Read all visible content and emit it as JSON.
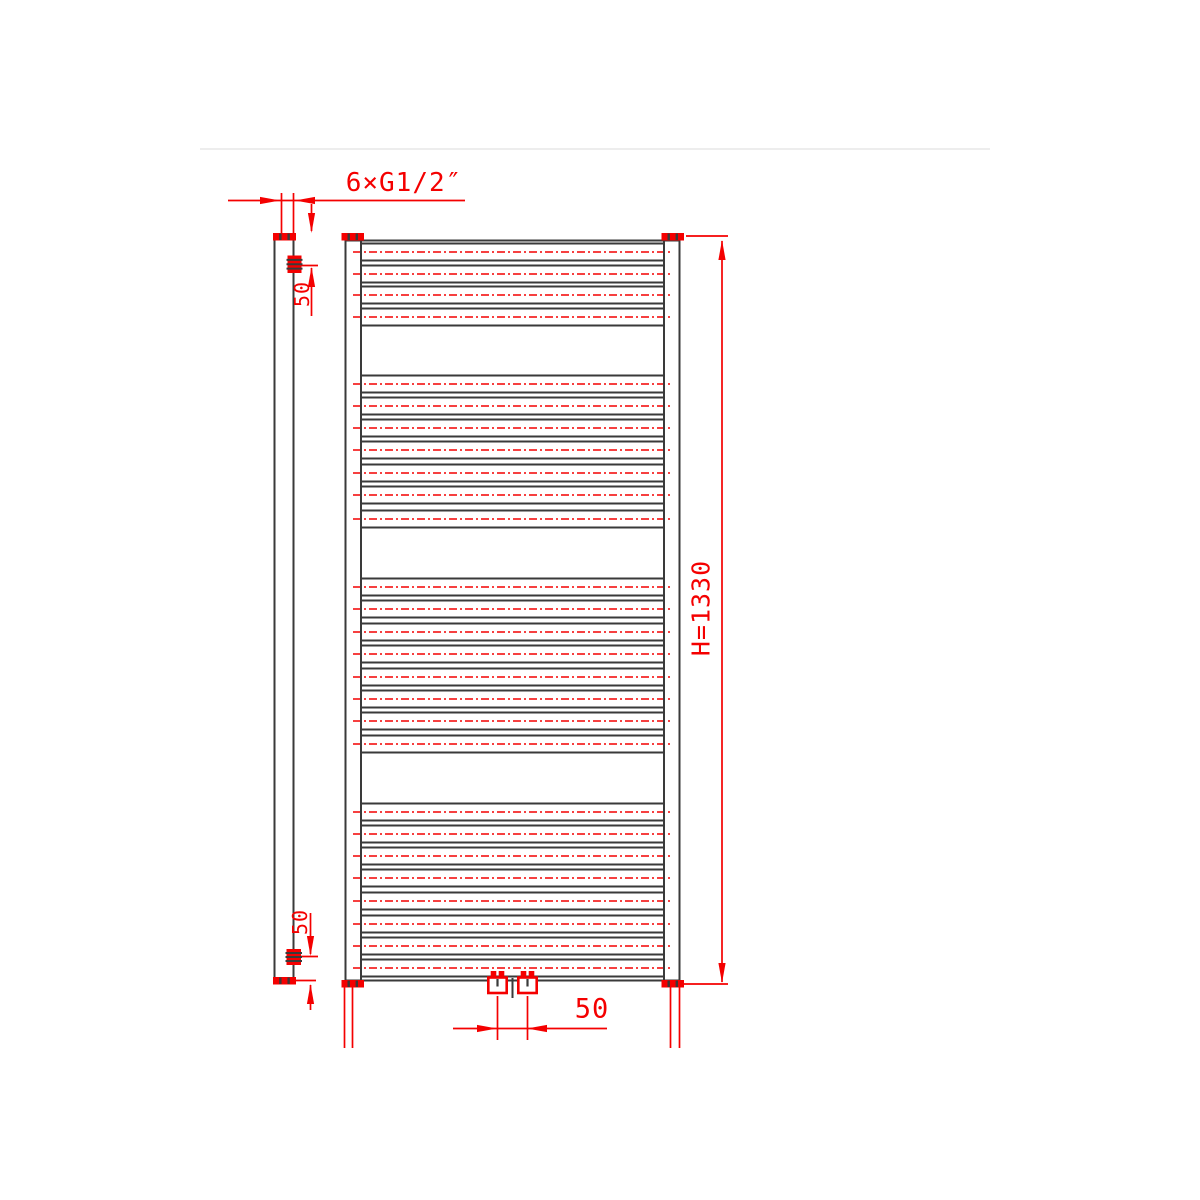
{
  "page": {
    "background": "#ffffff"
  },
  "colors": {
    "line": "#3a3a3a",
    "red": "#f40000",
    "faint_rule": "#ededed"
  },
  "drawing": {
    "type": "technical-drawing",
    "subject": "heated towel rail radiator - front and side elevation",
    "annotations": {
      "thread_note": "6×G1/2″",
      "height_dim": "H=1330",
      "top_offset_dim": "50",
      "bottom_offset_dim": "50",
      "center_spacing_dim": "50"
    },
    "front_view": {
      "left": 345.5,
      "right": 679.5,
      "top": 240.5,
      "bottom": 980.5,
      "tube_inner_left": 361,
      "tube_inner_right": 664,
      "rung_half_height": 8.5,
      "rung_extension_left": 353,
      "rung_extension_right": 672,
      "rung_groups": [
        [
          252,
          274,
          295,
          317
        ],
        [
          384,
          406,
          428,
          450,
          473,
          495,
          519
        ],
        [
          587,
          609,
          632,
          654,
          677,
          699,
          721,
          744
        ],
        [
          812,
          834,
          856,
          878,
          901,
          924,
          946,
          968
        ]
      ]
    },
    "geometry": {
      "faint_lines": [
        [
          200,
          149,
          990,
          149
        ]
      ],
      "black_lines": [
        [
          345.5,
          240,
          345.5,
          980
        ],
        [
          361,
          240,
          361,
          980
        ],
        [
          664,
          240,
          664,
          980
        ],
        [
          679.5,
          240,
          679.5,
          980
        ],
        [
          345.5,
          240.5,
          679.5,
          240.5
        ],
        [
          345.5,
          980.5,
          679.5,
          980.5
        ],
        [
          274.5,
          240,
          274.5,
          977
        ],
        [
          293.5,
          240,
          293.5,
          977
        ],
        [
          512.5,
          978,
          512.5,
          998
        ]
      ],
      "red_lines": [
        [
          228,
          200.5,
          465,
          200.5
        ],
        [
          281.5,
          193,
          281.5,
          237
        ],
        [
          293.5,
          193,
          293.5,
          237
        ],
        [
          311.5,
          204,
          311.5,
          231
        ],
        [
          311.5,
          268,
          311.5,
          316
        ],
        [
          296,
          265.5,
          318,
          265.5
        ],
        [
          722,
          241,
          722,
          982
        ],
        [
          686,
          236,
          728,
          236
        ],
        [
          684,
          984,
          728,
          984
        ],
        [
          310.5,
          913,
          310.5,
          954
        ],
        [
          310.5,
          985,
          310.5,
          1010
        ],
        [
          296,
          956.5,
          318,
          956.5
        ],
        [
          296,
          980.5,
          316,
          980.5
        ],
        [
          453,
          1028.5,
          607,
          1028.5
        ],
        [
          497.5,
          996,
          497.5,
          1040
        ],
        [
          527.5,
          996,
          527.5,
          1040
        ],
        [
          344.5,
          986,
          344.5,
          1048
        ],
        [
          352.5,
          986,
          352.5,
          1048
        ],
        [
          670.5,
          986,
          670.5,
          1048
        ],
        [
          679.5,
          986,
          679.5,
          1048
        ]
      ],
      "arrows": [
        [
          280,
          200.5,
          "right"
        ],
        [
          295,
          200.5,
          "left"
        ],
        [
          311.5,
          233,
          "down"
        ],
        [
          311.5,
          267,
          "up"
        ],
        [
          722,
          240,
          "up"
        ],
        [
          722,
          983,
          "down"
        ],
        [
          310.5,
          956,
          "down"
        ],
        [
          310.5,
          984,
          "up"
        ],
        [
          497,
          1028.5,
          "right"
        ],
        [
          527,
          1028.5,
          "left"
        ]
      ],
      "caps": [
        [
          341.5,
          233,
          22.5,
          7.5
        ],
        [
          661.5,
          233,
          22.5,
          7.5
        ],
        [
          341.5,
          980,
          22.5,
          7.5
        ],
        [
          661.5,
          980,
          22.5,
          7.5
        ],
        [
          273,
          233,
          23,
          7.5
        ],
        [
          273,
          977,
          23,
          7.5
        ]
      ],
      "side_fittings": [
        [
          287.5,
          255.5,
          14,
          17.5
        ],
        [
          286.5,
          949,
          14.5,
          16
        ]
      ],
      "bottom_fitting_centers": [
        497.5,
        527.5
      ]
    }
  }
}
